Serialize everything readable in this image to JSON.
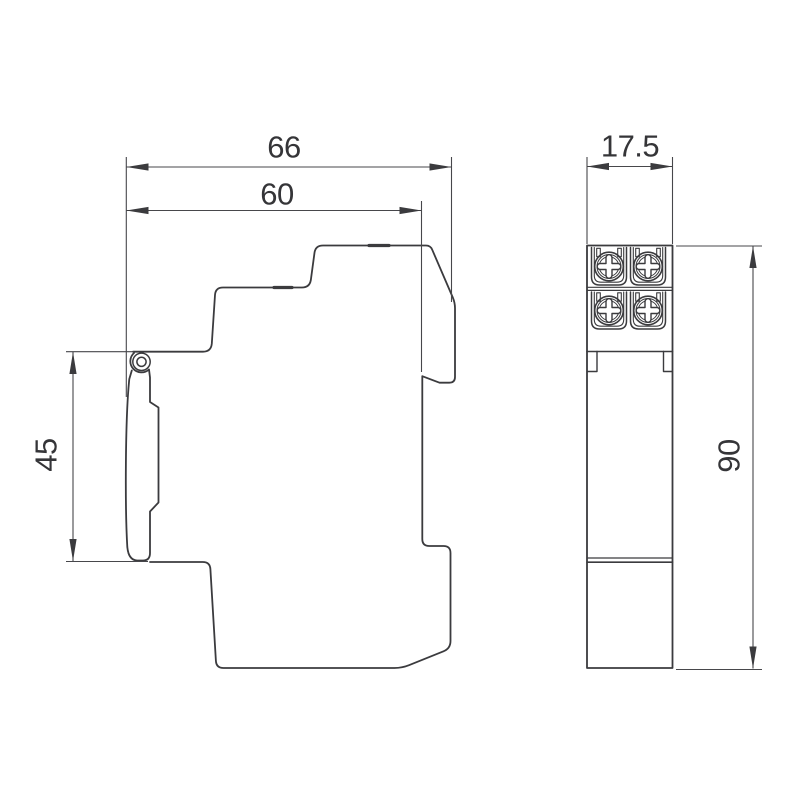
{
  "drawing": {
    "description": "Dimensional engineering drawing of a DIN-rail mounted device, side view and front view",
    "dimensions": {
      "overall_width": "66",
      "body_width": "60",
      "cover_height": "45",
      "module_width": "17.5",
      "overall_height": "90"
    },
    "colors": {
      "line": "#3b3b3e",
      "thin_line": "#47474b",
      "text": "#353538",
      "background": "#ffffff"
    }
  }
}
